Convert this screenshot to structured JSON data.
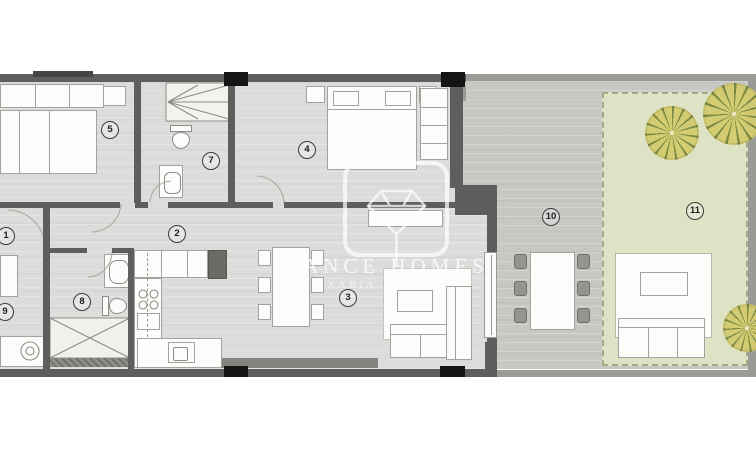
{
  "plan": {
    "type": "apartment-floor-plan",
    "areas": [
      "bedroom-5",
      "bathroom-7",
      "bedroom-4",
      "hallway-2",
      "room-1",
      "bathroom-8",
      "utility-9",
      "kitchen",
      "living-dining-3",
      "terrace-10",
      "garden-11"
    ]
  },
  "rooms": {
    "r1": "1",
    "r2": "2",
    "r3": "3",
    "r4": "4",
    "r5": "5",
    "r7": "7",
    "r8": "8",
    "r9": "9",
    "r10": "10",
    "r11": "11"
  },
  "watermark": {
    "logo": "diamond-icon",
    "line1": "ANCE HOMES",
    "line2": "XABIA"
  },
  "colors": {
    "floor": "#dcdcda",
    "terrace": "#c7c8c4",
    "garden": "#dde3c4",
    "garden_border": "#a4aa85",
    "wall": "#5e5e5c",
    "wall_outer": "#9a9a96",
    "pillar": "#141414",
    "furniture": "#fcfcfa",
    "furniture_border": "#a2a29e",
    "fixture_line": "#8c8c88",
    "tree_fill": "#d4cb6e",
    "tree_spike": "#79873e",
    "badge": "#3a3a3a"
  }
}
